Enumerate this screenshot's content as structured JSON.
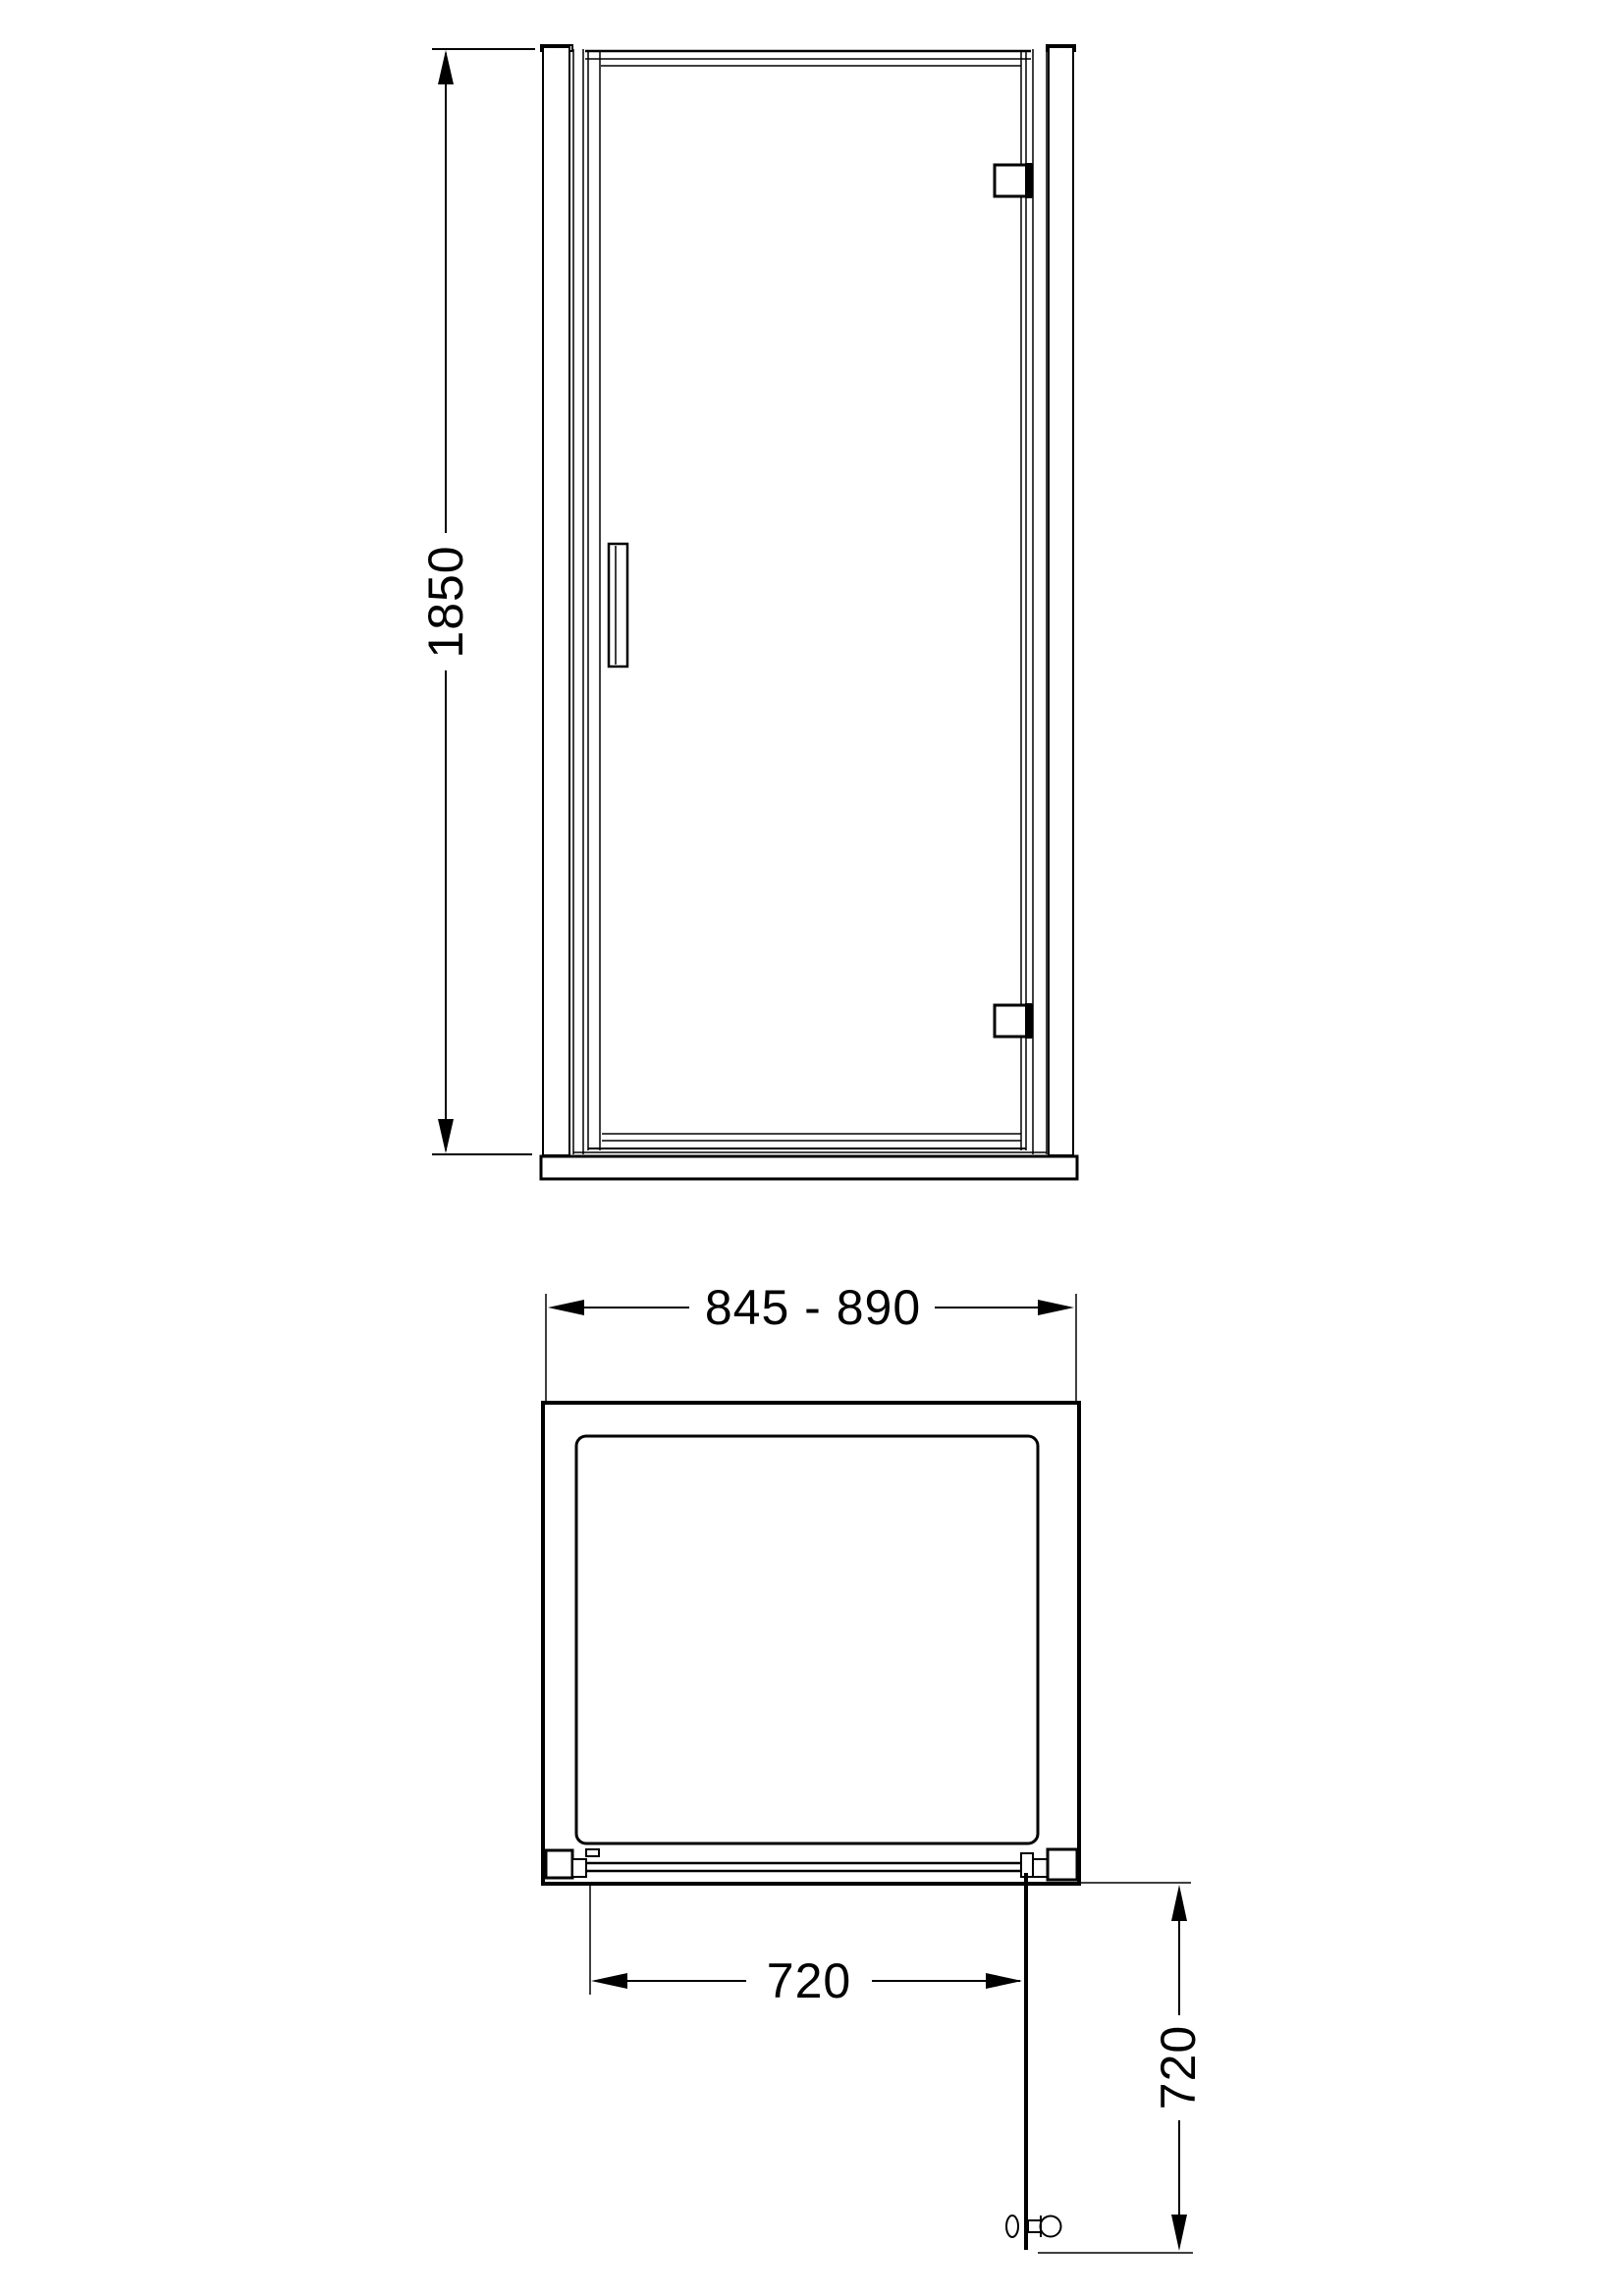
{
  "colors": {
    "line": "#000000",
    "background": "#ffffff"
  },
  "front_view": {
    "height_dimension": {
      "label": "1850"
    }
  },
  "plan_view": {
    "width_dimension": {
      "label": "845 - 890"
    },
    "door_width_dimension": {
      "label": "720"
    },
    "door_projection_dimension": {
      "label": "720"
    }
  }
}
